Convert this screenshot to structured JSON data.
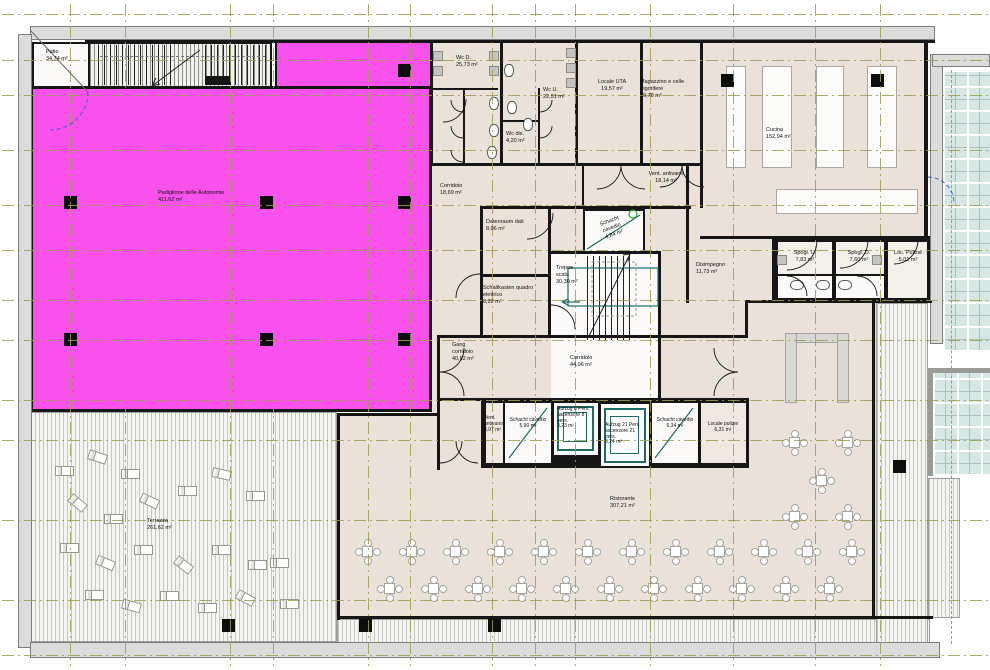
{
  "drawing": {
    "kind": "architectural floor plan",
    "colors": {
      "highlight": "#f951ec",
      "room_fill": "#eae2d8",
      "grid": "#9c9c52",
      "shaft": "#1e6a66",
      "glass": "#d7e7e3",
      "wall": "#161616",
      "door_blue": "#4356d6"
    },
    "rooms": {
      "patio": {
        "name": "Patio",
        "area": "34,74 m²"
      },
      "padiglione": {
        "name": "Padiglione delle Autonomie",
        "area": "411,62 m²"
      },
      "wc_d": {
        "name": "Wc D.",
        "area": "25,73 m²"
      },
      "wc_u": {
        "name": "Wc U.",
        "area": "22,51 m²"
      },
      "wc_dis": {
        "name": "Wc dis.",
        "area": "4,20 m²"
      },
      "locale_uta": {
        "name": "Locale UTA",
        "area": "19,57 m²"
      },
      "magazzino": {
        "name": "Magazzino e celle frigorifere",
        "area": "19,78 m²"
      },
      "cucina": {
        "name": "Cucina",
        "area": "152,94 m²"
      },
      "corridoio1": {
        "name": "Corridoio",
        "area": "18,69 m²"
      },
      "vent_antivano1": {
        "name": "Vent. antivano",
        "area": "18,14 m²"
      },
      "datenraum": {
        "name": "Datenraum dati",
        "area": "8,06 m²"
      },
      "schacht1": {
        "name": "Schacht cavedio",
        "area": "4,84 m²"
      },
      "treppe": {
        "name": "Treppe scala",
        "area": "30,30 m²"
      },
      "schaltkasten": {
        "name": "Schaltkasten quadro elettrico",
        "area": "8,22 m²"
      },
      "disimpegno": {
        "name": "Disimpegno",
        "area": "11,73 m²"
      },
      "spogl_u": {
        "name": "Spogl. U.",
        "area": "7,83 m²"
      },
      "spogl_d": {
        "name": "Spogl. D.",
        "area": "7,60 m²"
      },
      "loc_pulizie": {
        "name": "Loc. Pulizie",
        "area": "5,01 m²"
      },
      "gang": {
        "name": "Gang corridoio",
        "area": "40,62 m²"
      },
      "corridoio2": {
        "name": "Corridoio",
        "area": "44,06 m²"
      },
      "vent_antivano2": {
        "name": "Vent. antivano",
        "area": "3,97 m²"
      },
      "schacht2": {
        "name": "Schacht cavedio",
        "area": "5,90 m²"
      },
      "aufzug8": {
        "name": "Aufzug 8 Pers. ascensore 8 pers.",
        "area": "3,23 m²"
      },
      "aufzug21": {
        "name": "Aufzug 21 Pers. ascensore 21 pers.",
        "area": "6,24 m²"
      },
      "schacht3": {
        "name": "Schacht cavedio",
        "area": "6,34 m²"
      },
      "locale_pulizie2": {
        "name": "Locale pulizie",
        "area": "6,31 m²"
      },
      "ristorante": {
        "name": "Ristorante",
        "area": "307,21 m²"
      },
      "terrazza": {
        "name": "Terrazza",
        "area": "261,62 m²"
      }
    }
  }
}
